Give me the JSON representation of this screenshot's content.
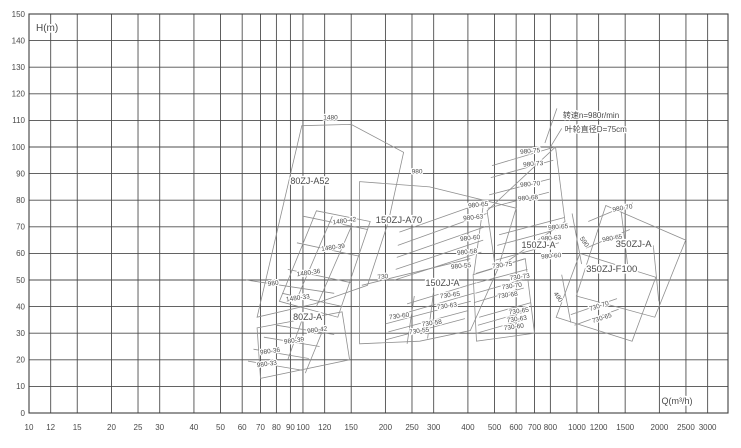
{
  "page": {
    "background": "#ffffff"
  },
  "colors": {
    "grid": "#4d4d4d",
    "border": "#3f3f3f",
    "envelope": "#8f8f8f",
    "tick_text": "#4a4a4a",
    "label_text": "#555555",
    "background": "#ffffff"
  },
  "annotation": {
    "speed": "转速n=980r/min",
    "impeller": "叶轮直径D=75cm"
  },
  "chart_data": {
    "type": "envelope-spectrum",
    "title": "",
    "xlabel": "Q(m³/h)",
    "ylabel": "H(m)",
    "x_scale": "log",
    "x_domain": [
      10,
      3560
    ],
    "y_domain": [
      0,
      150
    ],
    "grid": "on",
    "x_ticks": [
      10,
      12,
      15,
      20,
      25,
      30,
      40,
      50,
      60,
      70,
      80,
      90,
      100,
      120,
      150,
      200,
      250,
      300,
      400,
      500,
      600,
      700,
      800,
      1000,
      1200,
      1500,
      2000,
      2500,
      3000
    ],
    "y_ticks": [
      0,
      10,
      20,
      30,
      40,
      50,
      60,
      70,
      80,
      90,
      100,
      110,
      120,
      130,
      140,
      150
    ],
    "models": [
      {
        "model": "80ZJ-A52",
        "speed_curve_labels": [
          "1480",
          "980"
        ]
      },
      {
        "model": "80ZJ-A",
        "curve_labels": [
          "1480-42",
          "1480-39",
          "1480-36",
          "1480-33",
          "980-42",
          "980-39",
          "980-36",
          "980-33"
        ]
      },
      {
        "model": "150ZJ-A70",
        "speed_curve_labels": [
          "980",
          "730"
        ]
      },
      {
        "model": "150ZJ-A",
        "curve_labels": [
          "980-65",
          "980-63",
          "980-60",
          "980-58",
          "980-55",
          "730-65",
          "730-63",
          "730-60",
          "730-58",
          "730-55"
        ]
      },
      {
        "model": "150ZJ-A",
        "curve_labels": [
          "980-75",
          "980-73",
          "980-70",
          "980-68",
          "980-65",
          "980-63",
          "980-60",
          "730-75",
          "730-73",
          "730-70",
          "730-68",
          "730-65",
          "730-63",
          "730-60",
          "590",
          "490"
        ]
      },
      {
        "model": "350ZJ-A",
        "curve_labels": [
          "980-70",
          "980-65"
        ]
      },
      {
        "model": "350ZJ-F100",
        "curve_labels": [
          "730-70",
          "730-65"
        ]
      }
    ],
    "labels": [
      {
        "t": "1480",
        "q": 126,
        "h": 110.3
      },
      {
        "t": "80ZJ-A52",
        "q": 106,
        "h": 86,
        "s": 9
      },
      {
        "t": "980",
        "q": 261,
        "h": 90
      },
      {
        "t": "1480-42",
        "q": 142,
        "h": 71.5,
        "r": -8
      },
      {
        "t": "150ZJ-A70",
        "q": 224,
        "h": 71.5,
        "s": 9.5
      },
      {
        "t": "1480-39",
        "q": 129,
        "h": 61.5,
        "r": -8
      },
      {
        "t": "1480-36",
        "q": 105,
        "h": 52,
        "r": -8
      },
      {
        "t": "980",
        "q": 78,
        "h": 48,
        "r": -8
      },
      {
        "t": "1480-33",
        "q": 96,
        "h": 42.5,
        "r": -8
      },
      {
        "t": "80ZJ-A",
        "q": 104,
        "h": 35,
        "s": 9
      },
      {
        "t": "980-42",
        "q": 113,
        "h": 30.5,
        "r": -8
      },
      {
        "t": "980-39",
        "q": 93,
        "h": 26.5,
        "r": -8
      },
      {
        "t": "980-36",
        "q": 76,
        "h": 22.5,
        "r": -8
      },
      {
        "t": "980-33",
        "q": 74,
        "h": 17.7,
        "r": -8
      },
      {
        "t": "730",
        "q": 196,
        "h": 50.5,
        "r": -6
      },
      {
        "t": "980-65",
        "q": 437,
        "h": 77.5,
        "r": -6
      },
      {
        "t": "980-63",
        "q": 419,
        "h": 72.8,
        "r": -6
      },
      {
        "t": "980-60",
        "q": 408,
        "h": 65,
        "r": -6
      },
      {
        "t": "980-58",
        "q": 398,
        "h": 59.8,
        "r": -6
      },
      {
        "t": "980-55",
        "q": 378,
        "h": 54.5,
        "r": -6
      },
      {
        "t": "150ZJ-A",
        "q": 323,
        "h": 47.7,
        "s": 9
      },
      {
        "t": "730-65",
        "q": 345,
        "h": 43.6,
        "r": -8
      },
      {
        "t": "730-63",
        "q": 336,
        "h": 39.5,
        "r": -8
      },
      {
        "t": "730-60",
        "q": 225,
        "h": 35.7,
        "r": -8
      },
      {
        "t": "730-58",
        "q": 296,
        "h": 33.1,
        "r": -8
      },
      {
        "t": "730-55",
        "q": 266,
        "h": 30.1,
        "r": -8
      },
      {
        "t": "980-75",
        "q": 676,
        "h": 97.7,
        "r": -5
      },
      {
        "t": "980-73",
        "q": 693,
        "h": 92.9,
        "r": -5
      },
      {
        "t": "980-70",
        "q": 676,
        "h": 85.3,
        "r": -5
      },
      {
        "t": "980-68",
        "q": 664,
        "h": 80.1,
        "r": -5
      },
      {
        "t": "980-65",
        "q": 855,
        "h": 69.2,
        "r": -5
      },
      {
        "t": "980-63",
        "q": 806,
        "h": 65,
        "r": -5
      },
      {
        "t": "150ZJ-A",
        "q": 724,
        "h": 62,
        "s": 9
      },
      {
        "t": "590",
        "q": 1050,
        "h": 63.9,
        "r": 55
      },
      {
        "t": "980-60",
        "q": 806,
        "h": 58.3,
        "r": -5
      },
      {
        "t": "730-75",
        "q": 535,
        "h": 54.9,
        "r": -8
      },
      {
        "t": "730-73",
        "q": 620,
        "h": 50.4,
        "r": -8
      },
      {
        "t": "730-70",
        "q": 580,
        "h": 47,
        "r": -8
      },
      {
        "t": "730-68",
        "q": 560,
        "h": 43.6,
        "r": -8
      },
      {
        "t": "490",
        "q": 842,
        "h": 43.2,
        "r": 55
      },
      {
        "t": "730-65",
        "q": 615,
        "h": 37.6,
        "r": -8
      },
      {
        "t": "730-63",
        "q": 605,
        "h": 34.6,
        "r": -8
      },
      {
        "t": "730-60",
        "q": 590,
        "h": 31.6,
        "r": -8
      },
      {
        "t": "980-70",
        "q": 1470,
        "h": 76.3,
        "r": -10
      },
      {
        "t": "980-65",
        "q": 1350,
        "h": 65,
        "r": -10
      },
      {
        "t": "350ZJ-A",
        "q": 1610,
        "h": 62.4,
        "s": 9.5
      },
      {
        "t": "350ZJ-F100",
        "q": 1340,
        "h": 53,
        "s": 9.5
      },
      {
        "t": "730-70",
        "q": 1210,
        "h": 39.5,
        "r": -18
      },
      {
        "t": "730-65",
        "q": 1240,
        "h": 35,
        "r": -18
      }
    ],
    "annotations": [
      {
        "t": "转速n=980r/min",
        "q": 889,
        "h": 110.9,
        "s": 8,
        "a": "start"
      },
      {
        "t": "叶轮直径D=75cm",
        "q": 903,
        "h": 105.6,
        "s": 8,
        "a": "start"
      }
    ],
    "outlines": [
      [
        [
          99,
          108
        ],
        [
          150,
          108.5
        ],
        [
          233,
          98
        ],
        [
          205,
          72
        ],
        [
          172,
          48
        ],
        [
          110,
          41
        ],
        [
          68,
          36
        ],
        [
          82,
          72
        ]
      ],
      [
        [
          112,
          76
        ],
        [
          176,
          72
        ],
        [
          134,
          36
        ],
        [
          82,
          42
        ]
      ],
      [
        [
          68,
          32
        ],
        [
          139,
          38
        ],
        [
          148,
          20
        ],
        [
          70,
          13
        ]
      ],
      [
        [
          161,
          87
        ],
        [
          290,
          85
        ],
        [
          600,
          77
        ],
        [
          514,
          54
        ],
        [
          408,
          31
        ],
        [
          267,
          27
        ],
        [
          161,
          26
        ]
      ],
      [
        [
          470,
          76
        ],
        [
          835,
          100
        ],
        [
          905,
          72
        ],
        [
          505,
          54
        ]
      ],
      [
        [
          418,
          52
        ],
        [
          648,
          58
        ],
        [
          700,
          30
        ],
        [
          430,
          27
        ]
      ],
      [
        [
          1275,
          78
        ],
        [
          2495,
          65
        ],
        [
          1925,
          36
        ],
        [
          995,
          44
        ]
      ],
      [
        [
          1025,
          60
        ],
        [
          1940,
          51
        ],
        [
          1590,
          27
        ],
        [
          840,
          36
        ]
      ]
    ],
    "curves": [
      [
        [
          100,
          74
        ],
        [
          172,
          69
        ]
      ],
      [
        [
          95,
          64
        ],
        [
          160,
          59
        ]
      ],
      [
        [
          88,
          54
        ],
        [
          150,
          49
        ]
      ],
      [
        [
          84,
          45
        ],
        [
          140,
          40
        ]
      ],
      [
        [
          62,
          50
        ],
        [
          130,
          45
        ]
      ],
      [
        [
          80,
          33
        ],
        [
          130,
          29.5
        ]
      ],
      [
        [
          72,
          28.5
        ],
        [
          115,
          25
        ]
      ],
      [
        [
          66,
          24
        ],
        [
          105,
          20.5
        ]
      ],
      [
        [
          63,
          19.5
        ],
        [
          100,
          16
        ]
      ],
      [
        [
          150,
          70
        ],
        [
          112,
          40
        ]
      ],
      [
        [
          128,
          74
        ],
        [
          96,
          44
        ]
      ],
      [
        [
          118,
          31
        ],
        [
          102,
          15
        ]
      ],
      [
        [
          100,
          36
        ],
        [
          88,
          20
        ]
      ],
      [
        [
          164,
          48
        ],
        [
          408,
          58
        ]
      ],
      [
        [
          225,
          68
        ],
        [
          480,
          80
        ]
      ],
      [
        [
          222,
          63
        ],
        [
          468,
          75
        ]
      ],
      [
        [
          220,
          58.5
        ],
        [
          462,
          70
        ]
      ],
      [
        [
          218,
          54
        ],
        [
          455,
          65
        ]
      ],
      [
        [
          216,
          50
        ],
        [
          448,
          60.5
        ]
      ],
      [
        [
          240,
          41
        ],
        [
          430,
          49
        ]
      ],
      [
        [
          235,
          37.5
        ],
        [
          420,
          45
        ]
      ],
      [
        [
          200,
          33.5
        ],
        [
          410,
          42
        ]
      ],
      [
        [
          205,
          30.5
        ],
        [
          400,
          38.5
        ]
      ],
      [
        [
          200,
          27.5
        ],
        [
          390,
          35.5
        ]
      ],
      [
        [
          455,
          78
        ],
        [
          420,
          52
        ]
      ],
      [
        [
          300,
          46
        ],
        [
          285,
          28
        ]
      ],
      [
        [
          255,
          44
        ],
        [
          240,
          26
        ]
      ],
      [
        [
          490,
          93
        ],
        [
          830,
          100
        ]
      ],
      [
        [
          485,
          88.5
        ],
        [
          820,
          95
        ]
      ],
      [
        [
          478,
          82
        ],
        [
          800,
          88
        ]
      ],
      [
        [
          473,
          77
        ],
        [
          790,
          83
        ]
      ],
      [
        [
          520,
          67
        ],
        [
          900,
          73.5
        ]
      ],
      [
        [
          512,
          63
        ],
        [
          880,
          69.5
        ]
      ],
      [
        [
          505,
          57.5
        ],
        [
          860,
          64
        ]
      ],
      [
        [
          428,
          52.5
        ],
        [
          645,
          58
        ]
      ],
      [
        [
          432,
          49
        ],
        [
          660,
          54
        ]
      ],
      [
        [
          426,
          45
        ],
        [
          650,
          50.5
        ]
      ],
      [
        [
          421,
          41.5
        ],
        [
          640,
          47
        ]
      ],
      [
        [
          440,
          36
        ],
        [
          680,
          41.5
        ]
      ],
      [
        [
          435,
          33
        ],
        [
          670,
          38.5
        ]
      ],
      [
        [
          430,
          30
        ],
        [
          660,
          35.5
        ]
      ],
      [
        [
          960,
          75
        ],
        [
          1040,
          56
        ]
      ],
      [
        [
          880,
          52
        ],
        [
          950,
          34
        ]
      ],
      [
        [
          1100,
          72
        ],
        [
          1600,
          79
        ]
      ],
      [
        [
          1080,
          62
        ],
        [
          1560,
          69
        ]
      ],
      [
        [
          950,
          37
        ],
        [
          1400,
          43
        ]
      ],
      [
        [
          980,
          33
        ],
        [
          1420,
          39
        ]
      ],
      [
        [
          1900,
          63
        ],
        [
          1990,
          42
        ]
      ],
      [
        [
          1450,
          76
        ],
        [
          1530,
          56
        ]
      ]
    ],
    "leaders": [
      [
        [
          845,
          114.5
        ],
        [
          764,
          101.5
        ]
      ],
      [
        [
          880,
          107
        ],
        [
          795,
          99.5
        ]
      ]
    ]
  }
}
